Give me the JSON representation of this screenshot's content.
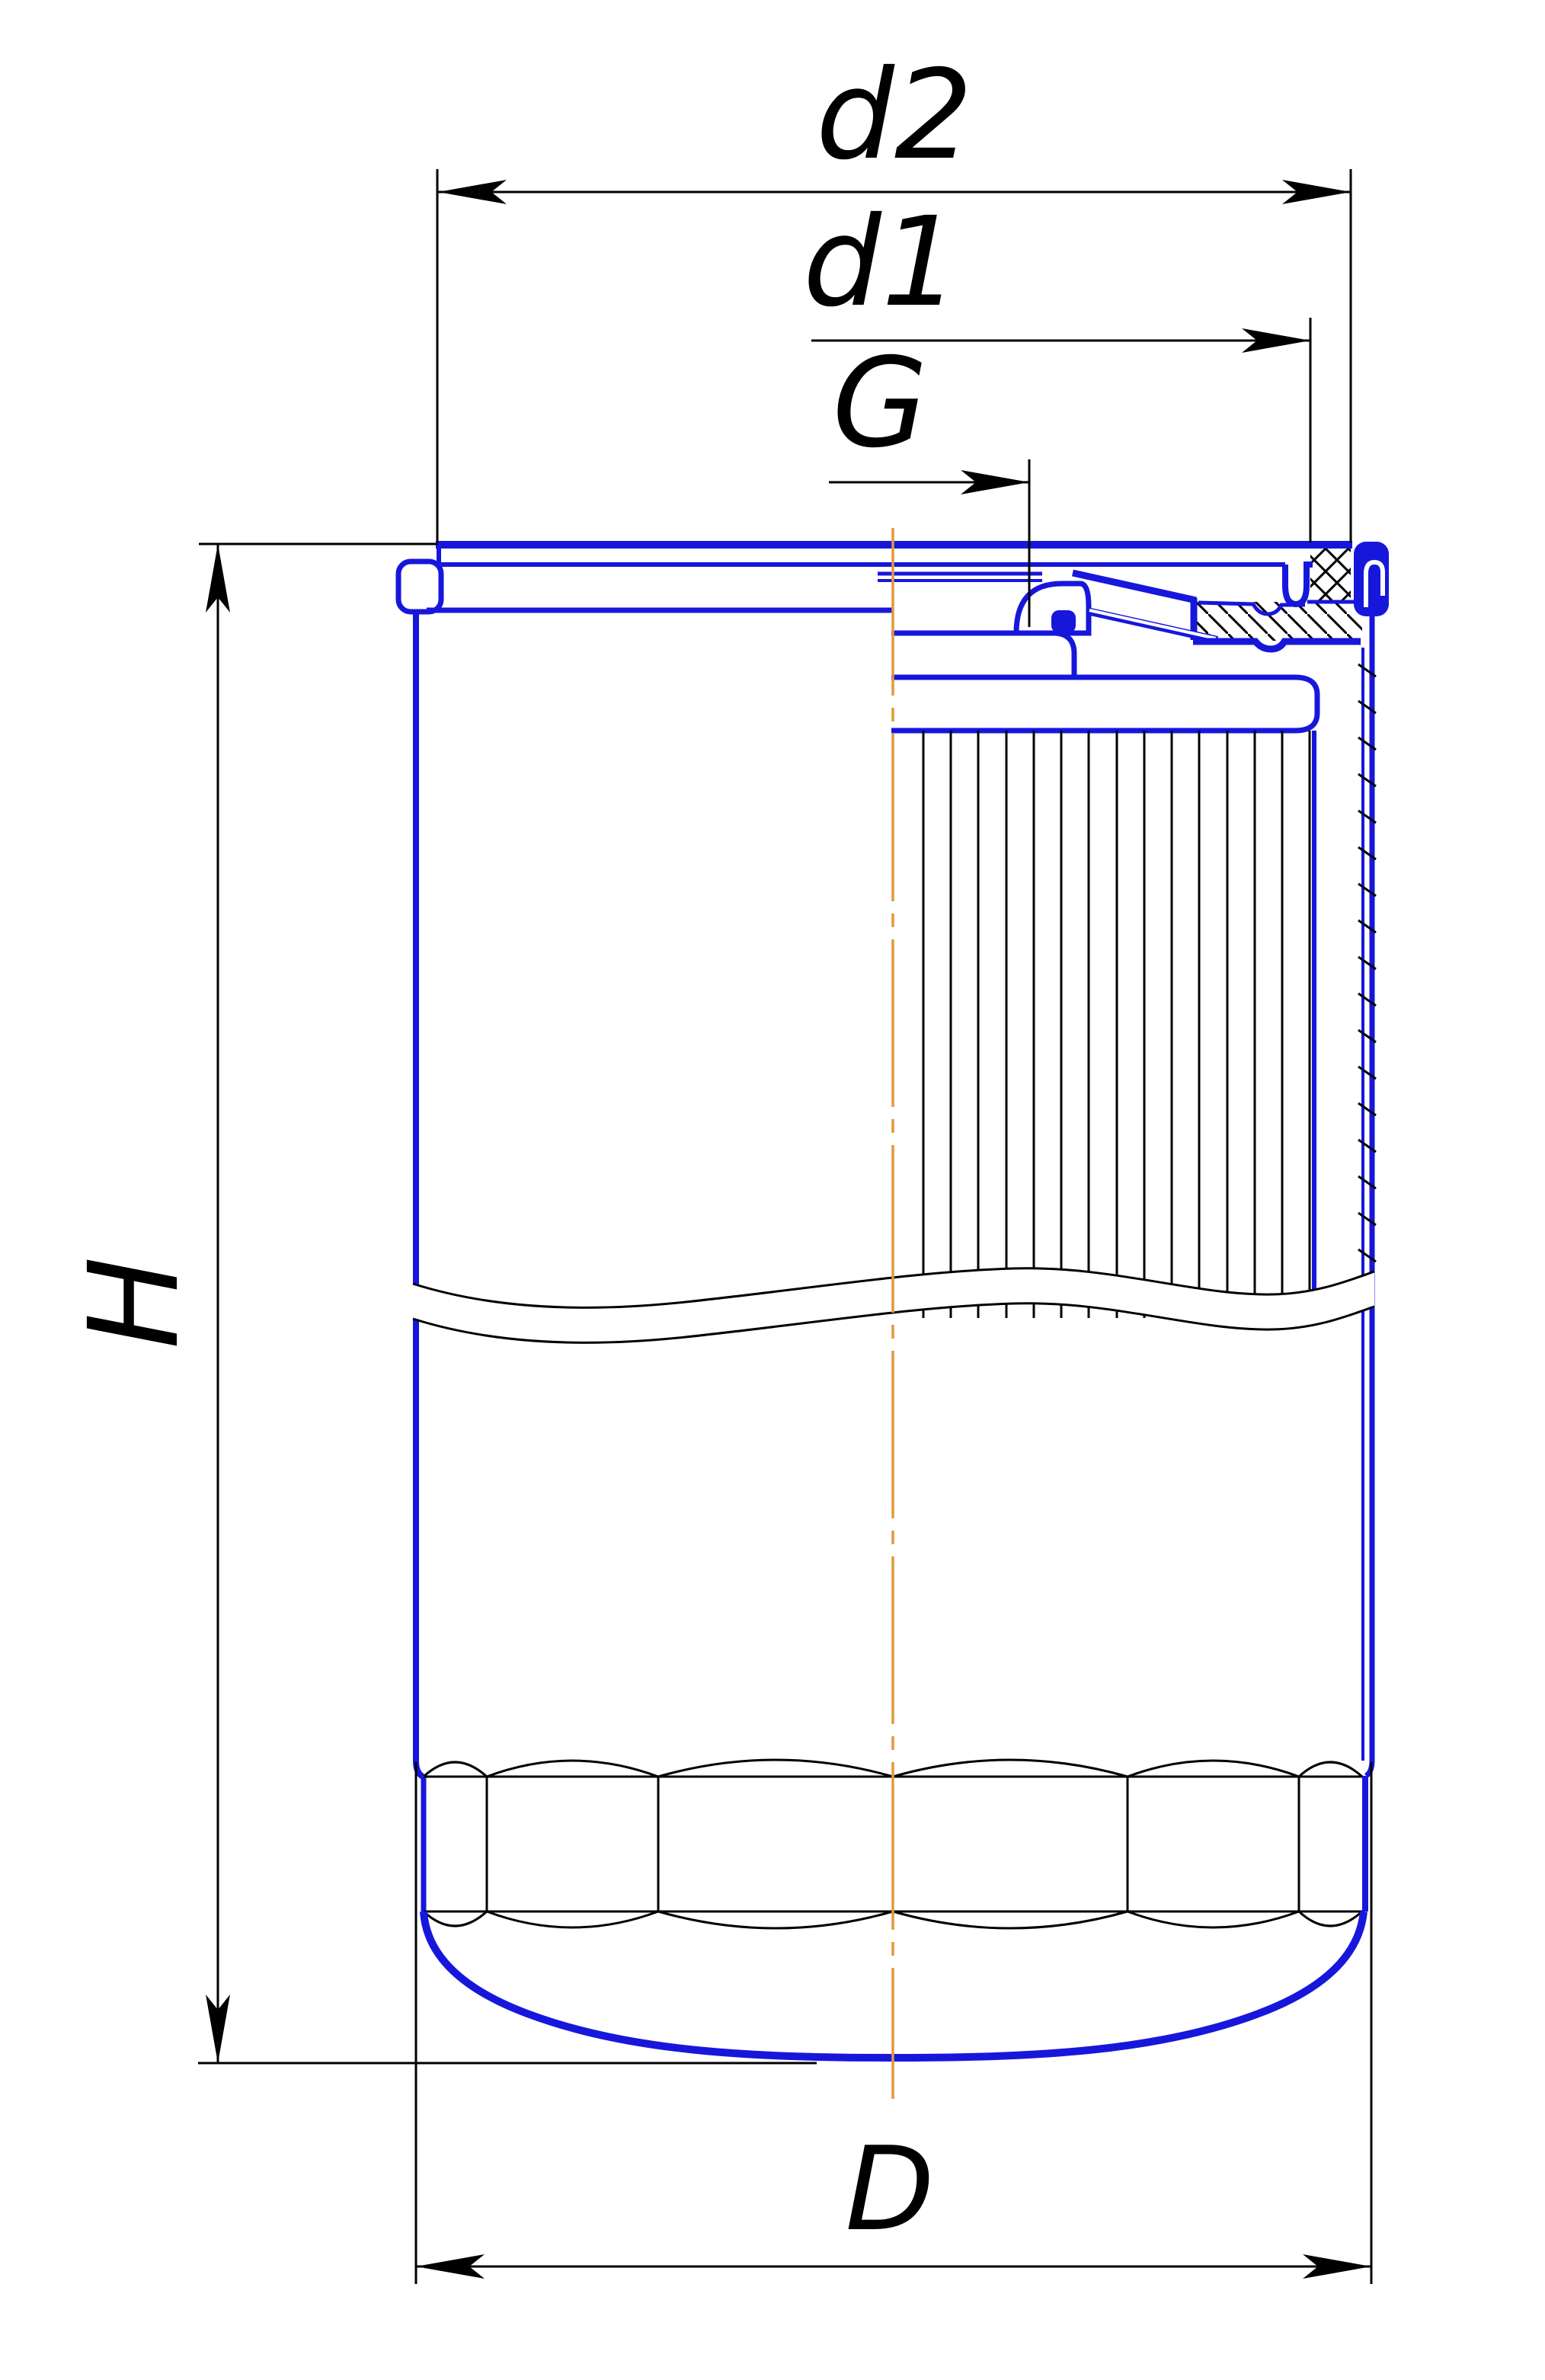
{
  "drawing": {
    "title": "spin-on oil filter half-section technical drawing",
    "dimension_labels": {
      "d2": "d2",
      "d1": "d1",
      "G": "G",
      "H": "H",
      "D": "D"
    },
    "colors": {
      "outline": "#1717db",
      "dimension": "#000000",
      "centerline": "#e29a38",
      "background": "#ffffff"
    }
  }
}
